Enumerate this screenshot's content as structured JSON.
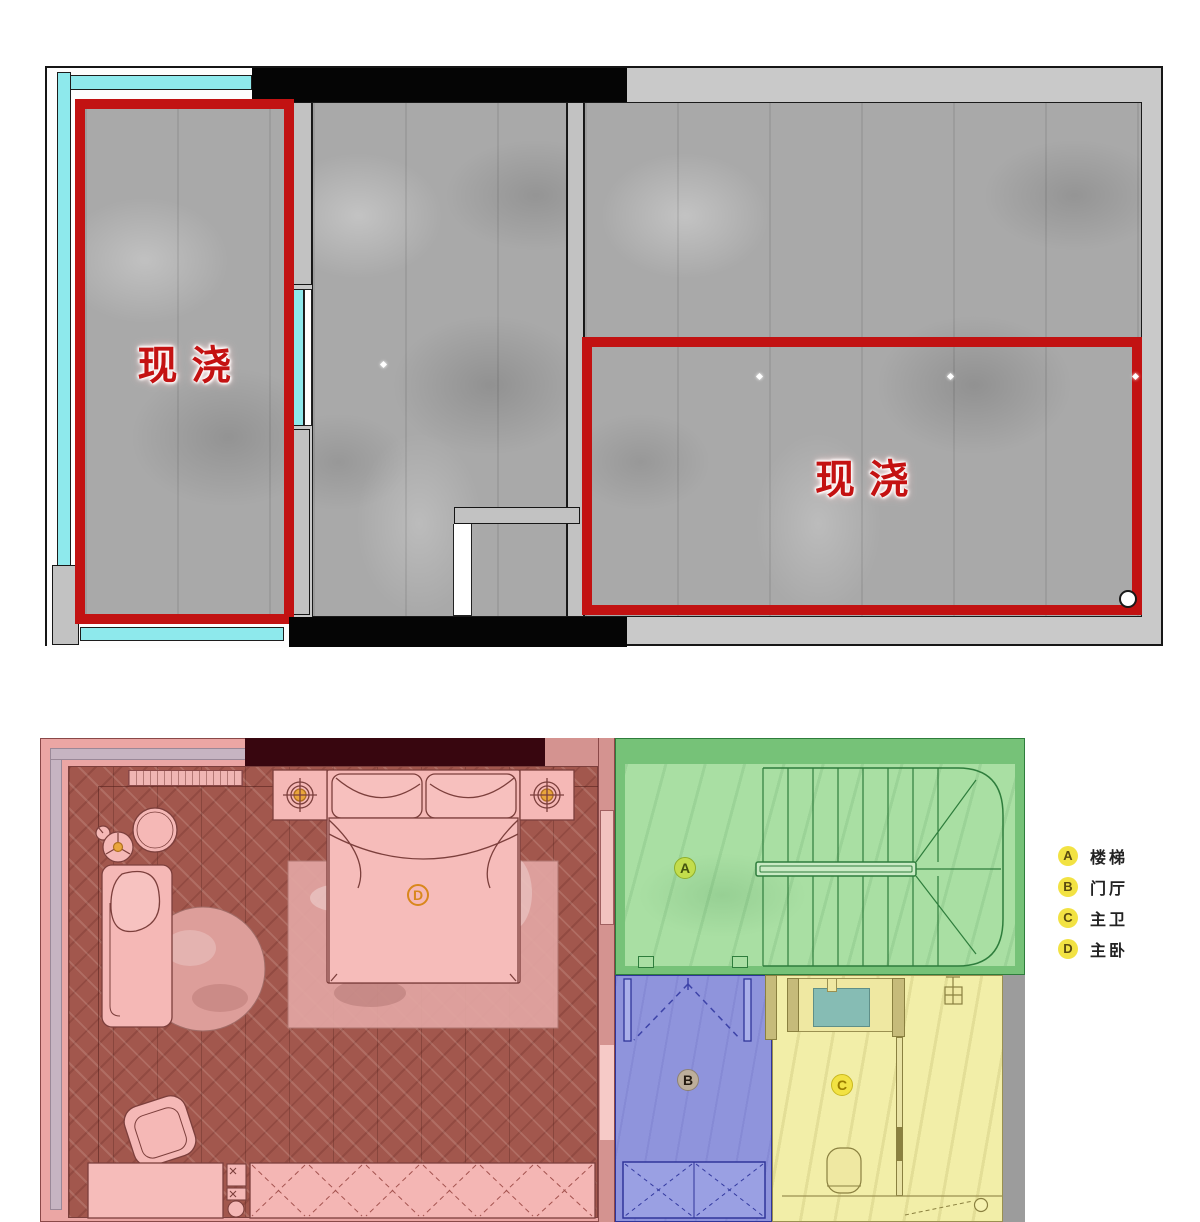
{
  "top_plan": {
    "regions": [
      {
        "label": "现浇",
        "meaning": "cast-in-place region (left balcony slab)"
      },
      {
        "label": "现浇",
        "meaning": "cast-in-place region (right slab)"
      }
    ],
    "colors": {
      "highlight_red": "#c21212",
      "window_cyan": "#8ee9ec",
      "concrete_gray": "#a9a9a9",
      "wall_gray": "#c2c2c2",
      "wall_black": "#050505"
    }
  },
  "bottom_plan": {
    "zones": [
      {
        "key": "A",
        "name": "楼梯",
        "fill": "#a9dfa3"
      },
      {
        "key": "B",
        "name": "门厅",
        "fill": "#8f94dc"
      },
      {
        "key": "C",
        "name": "主卫",
        "fill": "#f2eea8"
      },
      {
        "key": "D",
        "name": "主卧",
        "fill": "#c9766a"
      }
    ]
  },
  "legend": {
    "items": [
      {
        "key": "A",
        "label": "楼梯"
      },
      {
        "key": "B",
        "label": "门厅"
      },
      {
        "key": "C",
        "label": "主卫"
      },
      {
        "key": "D",
        "label": "主卧"
      }
    ]
  }
}
